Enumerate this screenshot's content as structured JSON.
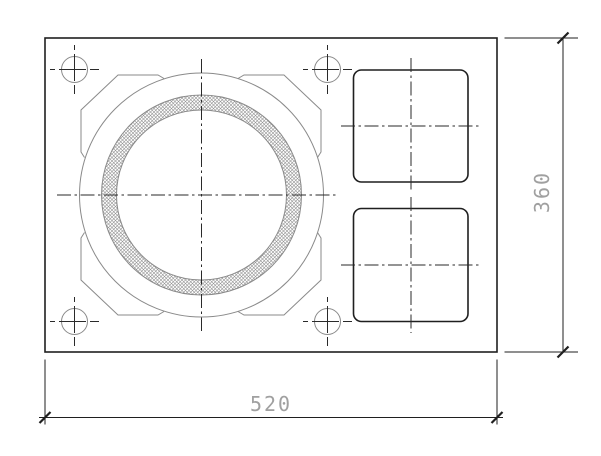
{
  "drawing": {
    "type": "cad-plan-view",
    "dimensions": {
      "width": {
        "label": "520"
      },
      "height": {
        "label": "360"
      }
    },
    "colors": {
      "background": "#ffffff",
      "object_line": "#1f1f1f",
      "thin_line": "#8a8a8a",
      "centerline": "#2a2a2a",
      "dimension_line": "#1f1f1f",
      "dimension_text": "#a0a0a0",
      "hatch": "#8f8f8f"
    }
  }
}
